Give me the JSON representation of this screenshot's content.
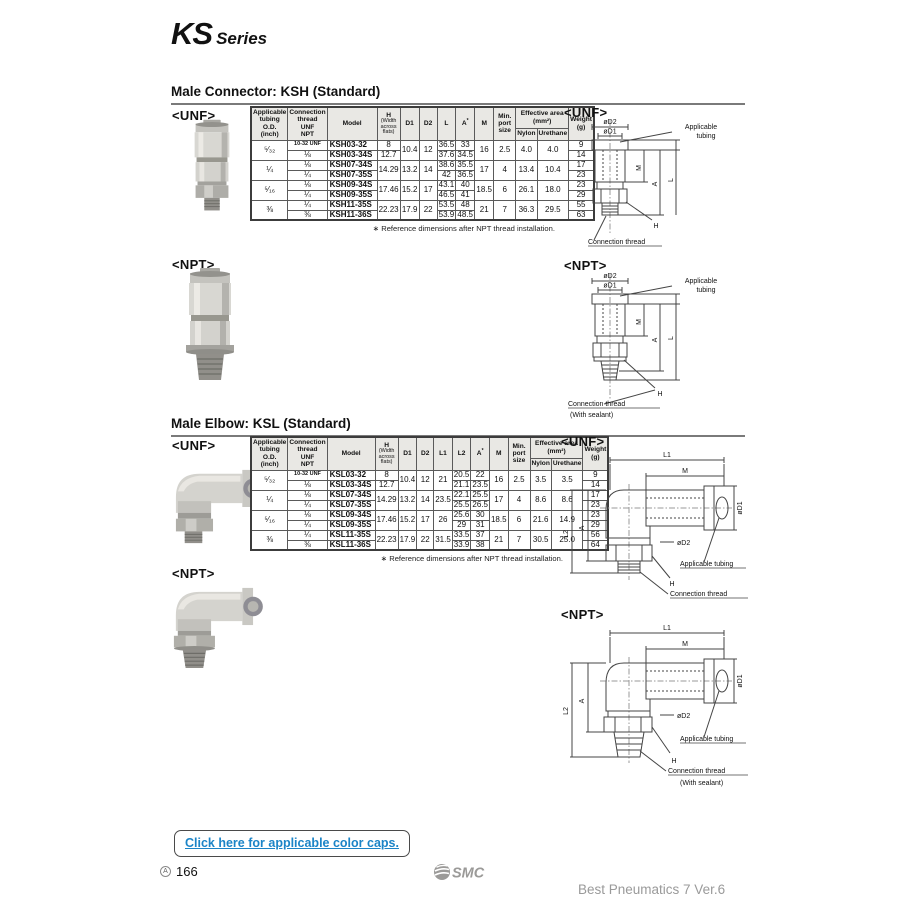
{
  "page": {
    "series_title": "KS",
    "series_subtitle": "Series",
    "page_marker": "A",
    "page_number": "166",
    "footer_logo": "SMC",
    "footer_text": "Best Pneumatics 7 Ver.6",
    "color_caps_link": "Click here for applicable color caps.",
    "accent_blue": "#1b84c7"
  },
  "labels": {
    "unf": "<UNF>",
    "npt": "<NPT>"
  },
  "dims": {
    "l1": "L1",
    "l2": "L2",
    "l": "L",
    "m": "M",
    "a": "A",
    "h": "H",
    "d1": "øD1",
    "d2": "øD2",
    "tubing": "Applicable tubing",
    "tubing_line1": "Applicable",
    "tubing_line2": "tubing",
    "thread": "Connection thread",
    "sealant": "(With sealant)"
  },
  "ksh": {
    "heading": "Male Connector: KSH (Standard)",
    "footnote": "∗ Reference dimensions after NPT thread installation.",
    "table": {
      "header_top": [
        {
          "label": "Applicable\ntubing\nO.D.\n(inch)",
          "rowspan": 2,
          "w": 34
        },
        {
          "label": "Connection\nthread\nUNF\nNPT",
          "rowspan": 2,
          "w": 30
        },
        {
          "label": "Model",
          "rowspan": 2,
          "w": 50
        },
        {
          "label": "H",
          "sub": "(Width\nacross\nflats)",
          "rowspan": 2,
          "w": 18
        },
        {
          "label": "D1",
          "rowspan": 2,
          "w": 19
        },
        {
          "label": "D2",
          "rowspan": 2,
          "w": 18
        },
        {
          "label": "L",
          "rowspan": 2,
          "w": 17
        },
        {
          "label": "A",
          "sup": "*",
          "rowspan": 2,
          "w": 19
        },
        {
          "label": "M",
          "rowspan": 2,
          "w": 19
        },
        {
          "label": "Min.\nport\nsize",
          "rowspan": 2,
          "w": 22
        },
        {
          "label": "Effective area\n(mm²)",
          "colspan": 2
        },
        {
          "label": "Weight\n(g)",
          "rowspan": 2,
          "w": 20
        }
      ],
      "header_sub": [
        {
          "label": "Nylon",
          "w": 18
        },
        {
          "label": "Urethane",
          "w": 20
        }
      ],
      "cols": [
        {
          "key": "size"
        },
        {
          "key": "thread",
          "cls": "thread"
        },
        {
          "key": "model",
          "cls": "model"
        },
        {
          "key": "h"
        },
        {
          "key": "d1"
        },
        {
          "key": "d2"
        },
        {
          "key": "l"
        },
        {
          "key": "a"
        },
        {
          "key": "m"
        },
        {
          "key": "port"
        },
        {
          "key": "nylon"
        },
        {
          "key": "urethane"
        },
        {
          "key": "weight"
        }
      ],
      "groups": [
        {
          "shared": {
            "size": "⁵⁄₃₂",
            "d1": "10.4",
            "d2": "12",
            "m": "16",
            "port": "2.5",
            "nylon": "4.0",
            "urethane": "4.0"
          },
          "rows": [
            {
              "thread": "10-32 UNF",
              "model": "KSH03-32",
              "h": "8",
              "l": "36.5",
              "a": "33",
              "weight": "9"
            },
            {
              "thread": "⅛",
              "model": "KSH03-34S",
              "h": "12.7",
              "l": "37.6",
              "a": "34.5",
              "weight": "14"
            }
          ]
        },
        {
          "shared": {
            "size": "¼",
            "h": "14.29",
            "d1": "13.2",
            "d2": "14",
            "m": "17",
            "port": "4",
            "nylon": "13.4",
            "urethane": "10.4"
          },
          "rows": [
            {
              "thread": "⅛",
              "model": "KSH07-34S",
              "l": "38.6",
              "a": "35.5",
              "weight": "17"
            },
            {
              "thread": "¼",
              "model": "KSH07-35S",
              "l": "42",
              "a": "36.5",
              "weight": "23"
            }
          ]
        },
        {
          "shared": {
            "size": "⁵⁄₁₆",
            "h": "17.46",
            "d1": "15.2",
            "d2": "17",
            "m": "18.5",
            "port": "6",
            "nylon": "26.1",
            "urethane": "18.0"
          },
          "rows": [
            {
              "thread": "⅛",
              "model": "KSH09-34S",
              "l": "43.1",
              "a": "40",
              "weight": "23"
            },
            {
              "thread": "¼",
              "model": "KSH09-35S",
              "l": "46.5",
              "a": "41",
              "weight": "29"
            }
          ]
        },
        {
          "shared": {
            "size": "⅜",
            "h": "22.23",
            "d1": "17.9",
            "d2": "22",
            "m": "21",
            "port": "7",
            "nylon": "36.3",
            "urethane": "29.5"
          },
          "rows": [
            {
              "thread": "¼",
              "model": "KSH11-35S",
              "l": "53.5",
              "a": "48",
              "weight": "55"
            },
            {
              "thread": "⅜",
              "model": "KSH11-36S",
              "l": "53.9",
              "a": "48.5",
              "weight": "63"
            }
          ]
        }
      ]
    }
  },
  "ksl": {
    "heading": "Male Elbow: KSL (Standard)",
    "footnote": "∗ Reference dimensions after NPT thread installation.",
    "table": {
      "header_top": [
        {
          "label": "Applicable\ntubing\nO.D.\n(inch)",
          "rowspan": 2,
          "w": 33
        },
        {
          "label": "Connection\nthread\nUNF\nNPT",
          "rowspan": 2,
          "w": 29
        },
        {
          "label": "Model",
          "rowspan": 2,
          "w": 48
        },
        {
          "label": "H",
          "sub": "(Width\nacross\nflats)",
          "rowspan": 2,
          "w": 18
        },
        {
          "label": "D1",
          "rowspan": 2,
          "w": 18
        },
        {
          "label": "D2",
          "rowspan": 2,
          "w": 17
        },
        {
          "label": "L1",
          "rowspan": 2,
          "w": 17
        },
        {
          "label": "L2",
          "rowspan": 2,
          "w": 17
        },
        {
          "label": "A",
          "sup": "*",
          "rowspan": 2,
          "w": 17
        },
        {
          "label": "M",
          "rowspan": 2,
          "w": 18
        },
        {
          "label": "Min.\nport\nsize",
          "rowspan": 2,
          "w": 22
        },
        {
          "label": "Effective area\n(mm²)",
          "colspan": 2
        },
        {
          "label": "Weight\n(g)",
          "rowspan": 2,
          "w": 20
        }
      ],
      "header_sub": [
        {
          "label": "Nylon",
          "w": 18
        },
        {
          "label": "Urethane",
          "w": 20
        }
      ],
      "cols": [
        {
          "key": "size"
        },
        {
          "key": "thread",
          "cls": "thread"
        },
        {
          "key": "model",
          "cls": "model"
        },
        {
          "key": "h"
        },
        {
          "key": "d1"
        },
        {
          "key": "d2"
        },
        {
          "key": "l1"
        },
        {
          "key": "l2"
        },
        {
          "key": "a"
        },
        {
          "key": "m"
        },
        {
          "key": "port"
        },
        {
          "key": "nylon"
        },
        {
          "key": "urethane"
        },
        {
          "key": "weight"
        }
      ],
      "groups": [
        {
          "shared": {
            "size": "⁵⁄₃₂",
            "d1": "10.4",
            "d2": "12",
            "l1": "21",
            "m": "16",
            "port": "2.5",
            "nylon": "3.5",
            "urethane": "3.5"
          },
          "rows": [
            {
              "thread": "10-32 UNF",
              "model": "KSL03-32",
              "h": "8",
              "l2": "20.5",
              "a": "22",
              "weight": "9"
            },
            {
              "thread": "⅛",
              "model": "KSL03-34S",
              "h": "12.7",
              "l2": "21.1",
              "a": "23.5",
              "weight": "14"
            }
          ]
        },
        {
          "shared": {
            "size": "¼",
            "h": "14.29",
            "d1": "13.2",
            "d2": "14",
            "l1": "23.5",
            "m": "17",
            "port": "4",
            "nylon": "8.6",
            "urethane": "8.6"
          },
          "rows": [
            {
              "thread": "⅛",
              "model": "KSL07-34S",
              "l2": "22.1",
              "a": "25.5",
              "weight": "17"
            },
            {
              "thread": "¼",
              "model": "KSL07-35S",
              "l2": "25.5",
              "a": "26.5",
              "weight": "23"
            }
          ]
        },
        {
          "shared": {
            "size": "⁵⁄₁₆",
            "h": "17.46",
            "d1": "15.2",
            "d2": "17",
            "l1": "26",
            "m": "18.5",
            "port": "6",
            "nylon": "21.6",
            "urethane": "14.9"
          },
          "rows": [
            {
              "thread": "⅛",
              "model": "KSL09-34S",
              "l2": "25.6",
              "a": "30",
              "weight": "23"
            },
            {
              "thread": "¼",
              "model": "KSL09-35S",
              "l2": "29",
              "a": "31",
              "weight": "29"
            }
          ]
        },
        {
          "shared": {
            "size": "⅜",
            "h": "22.23",
            "d1": "17.9",
            "d2": "22",
            "l1": "31.5",
            "m": "21",
            "port": "7",
            "nylon": "30.5",
            "urethane": "25.0"
          },
          "rows": [
            {
              "thread": "¼",
              "model": "KSL11-35S",
              "l2": "33.5",
              "a": "37",
              "weight": "56"
            },
            {
              "thread": "⅜",
              "model": "KSL11-36S",
              "l2": "33.9",
              "a": "38",
              "weight": "64"
            }
          ]
        }
      ]
    }
  }
}
